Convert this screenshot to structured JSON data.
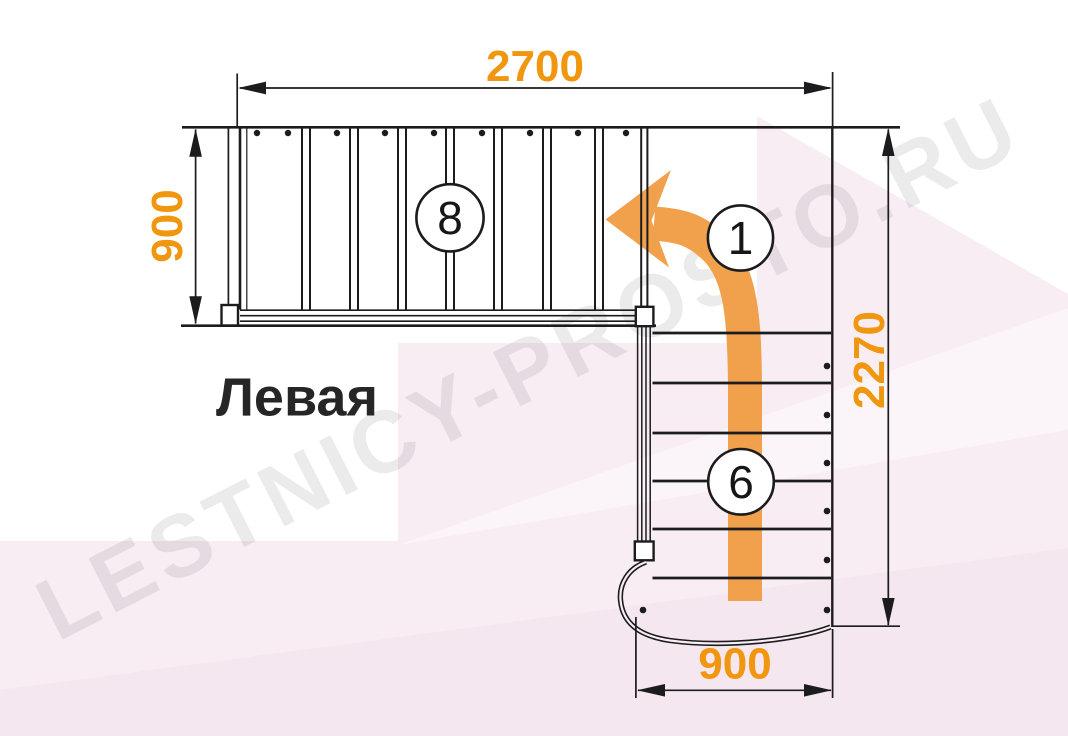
{
  "watermark": {
    "text": "LESTNICY-PROSTO.RU"
  },
  "stair": {
    "side_label": "Левая",
    "upper_flight_steps": "8",
    "turn_marker": "1",
    "lower_flight_steps": "6"
  },
  "dimensions": {
    "top_length": "2700",
    "flight_width": "900",
    "total_depth": "2270",
    "lower_flight_width": "900"
  },
  "colors": {
    "ink": "#1c1c1e",
    "dim_orange": "#f0970f",
    "arrow_orange": "#f1a14b",
    "bg_pink": "#f9edf4",
    "bg_pink_deep": "#f5e7ef",
    "watermark_col": "rgba(73,54,66,0.10)",
    "label_ink": "#262626"
  }
}
